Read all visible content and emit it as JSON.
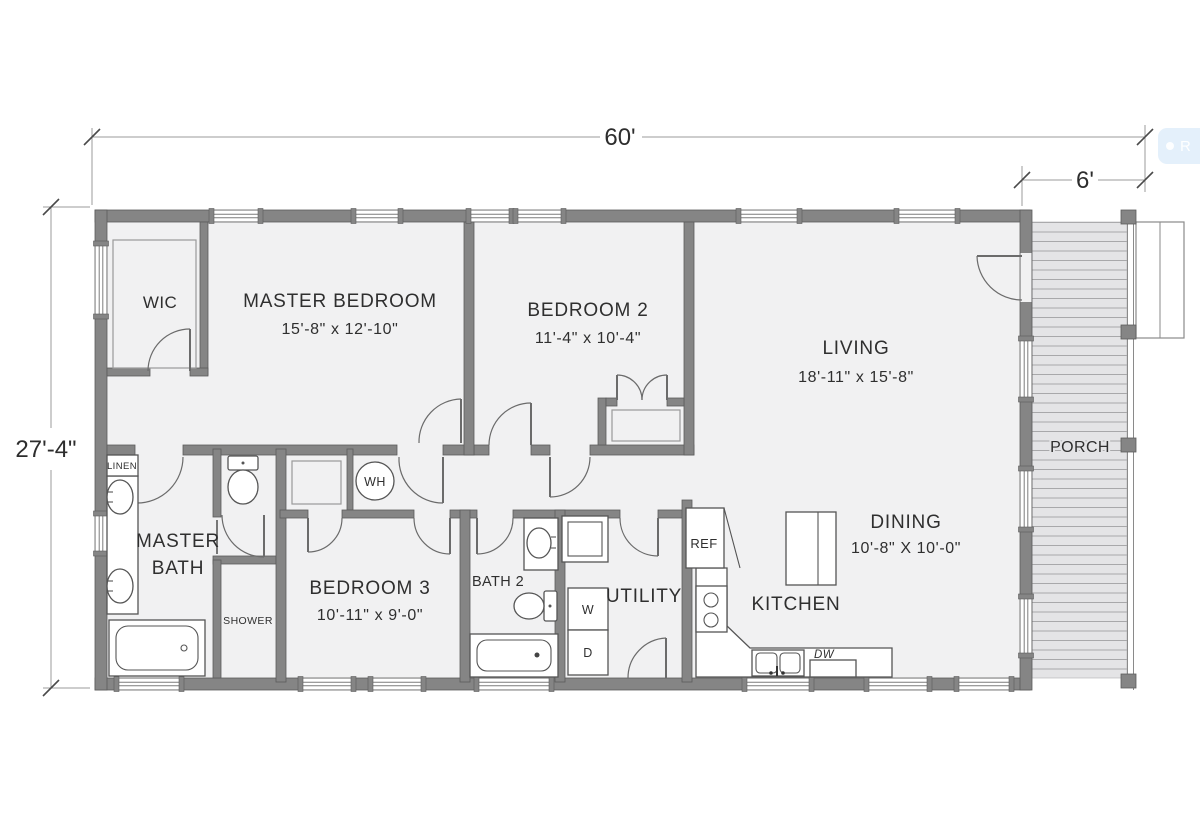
{
  "plan_title": "single-story house floor plan",
  "dimensions": {
    "overall_width": "60'",
    "porch_width": "6'",
    "overall_depth": "27'-4\""
  },
  "labels": {
    "wic": "WIC",
    "master_bedroom": "MASTER BEDROOM",
    "master_bedroom_size": "15'-8\" x 12'-10\"",
    "bedroom2": "BEDROOM 2",
    "bedroom2_size": "11'-4\" x 10'-4\"",
    "living": "LIVING",
    "living_size": "18'-11\" x 15'-8\"",
    "porch": "PORCH",
    "master_bath_line1": "MASTER",
    "master_bath_line2": "BATH",
    "linen": "LINEN",
    "shower": "SHOWER",
    "water_heater": "WH",
    "bedroom3": "BEDROOM 3",
    "bedroom3_size": "10'-11\" x 9'-0\"",
    "bath2": "BATH 2",
    "utility": "UTILITY",
    "washer": "W",
    "dryer": "D",
    "kitchen": "KITCHEN",
    "refrigerator": "REF",
    "dishwasher": "DW",
    "dining": "DINING",
    "dining_size": "10'-8\" X 10'-0\""
  },
  "overlay": {
    "button_label": "R"
  },
  "colors": {
    "wall": "#858585",
    "room_fill": "#f1f1f2",
    "porch_fill": "#e4e4e6",
    "deck_line": "#a8a8aa",
    "text": "#2f2f2f",
    "overlay_button": "#cee3f7"
  }
}
